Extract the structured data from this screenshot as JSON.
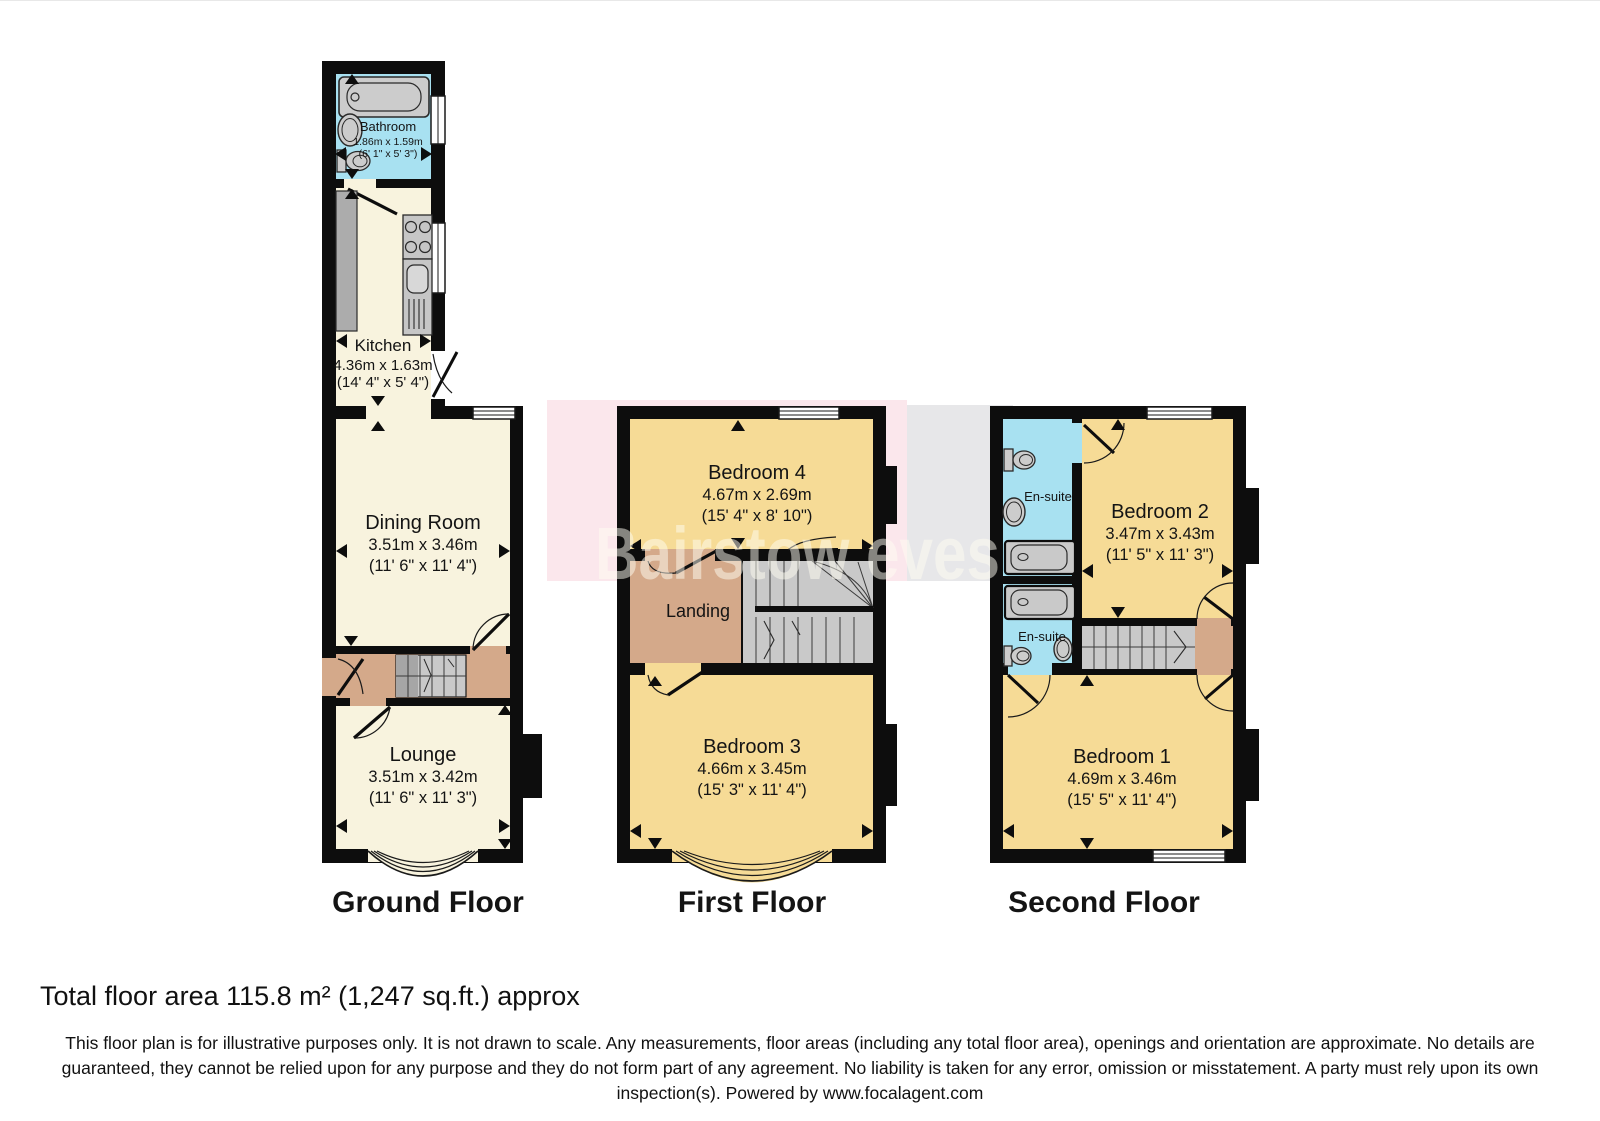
{
  "watermark": {
    "text": "Bairstow eves"
  },
  "floors": {
    "ground": {
      "label": "Ground Floor",
      "bathroom": {
        "name": "Bathroom",
        "metric": "1.86m x 1.59m",
        "imperial": "(6' 1\" x 5' 3\")"
      },
      "kitchen": {
        "name": "Kitchen",
        "metric": "4.36m x 1.63m",
        "imperial": "(14' 4\" x 5' 4\")"
      },
      "dining": {
        "name": "Dining Room",
        "metric": "3.51m x 3.46m",
        "imperial": "(11' 6\" x 11' 4\")"
      },
      "lounge": {
        "name": "Lounge",
        "metric": "3.51m x 3.42m",
        "imperial": "(11' 6\" x 11' 3\")"
      }
    },
    "first": {
      "label": "First Floor",
      "bedroom4": {
        "name": "Bedroom 4",
        "metric": "4.67m x 2.69m",
        "imperial": "(15' 4\" x 8' 10\")"
      },
      "landing": {
        "name": "Landing"
      },
      "bedroom3": {
        "name": "Bedroom 3",
        "metric": "4.66m x 3.45m",
        "imperial": "(15' 3\" x 11' 4\")"
      }
    },
    "second": {
      "label": "Second Floor",
      "ensuite1": {
        "name": "En-suite"
      },
      "ensuite2": {
        "name": "En-suite"
      },
      "bedroom2": {
        "name": "Bedroom 2",
        "metric": "3.47m x 3.43m",
        "imperial": "(11' 5\" x 11' 3\")"
      },
      "bedroom1": {
        "name": "Bedroom 1",
        "metric": "4.69m x 3.46m",
        "imperial": "(15' 5\" x 11' 4\")"
      }
    }
  },
  "footer": {
    "total_area": "Total floor area 115.8 m² (1,247 sq.ft.) approx",
    "disclaimer": "This floor plan is for illustrative purposes only. It is not drawn to scale. Any measurements, floor areas (including any total floor area), openings and orientation are approximate. No details are guaranteed, they cannot be relied upon for any purpose and they do not form part of any agreement. No liability is taken for any error, omission or misstatement. A party must rely upon its own inspection(s). Powered by www.focalagent.com"
  },
  "colors": {
    "wall": "#0d0d0d",
    "room_cream": "#f8f3de",
    "room_yellow": "#f6db96",
    "room_cyan": "#a8e1f1",
    "hall_tan": "#d4a98a",
    "stair_gray": "#c9c9c9",
    "fixture_gray": "#cccccc",
    "watermark_pink": "#fbe7ec",
    "watermark_gray": "#e7e7e9"
  }
}
